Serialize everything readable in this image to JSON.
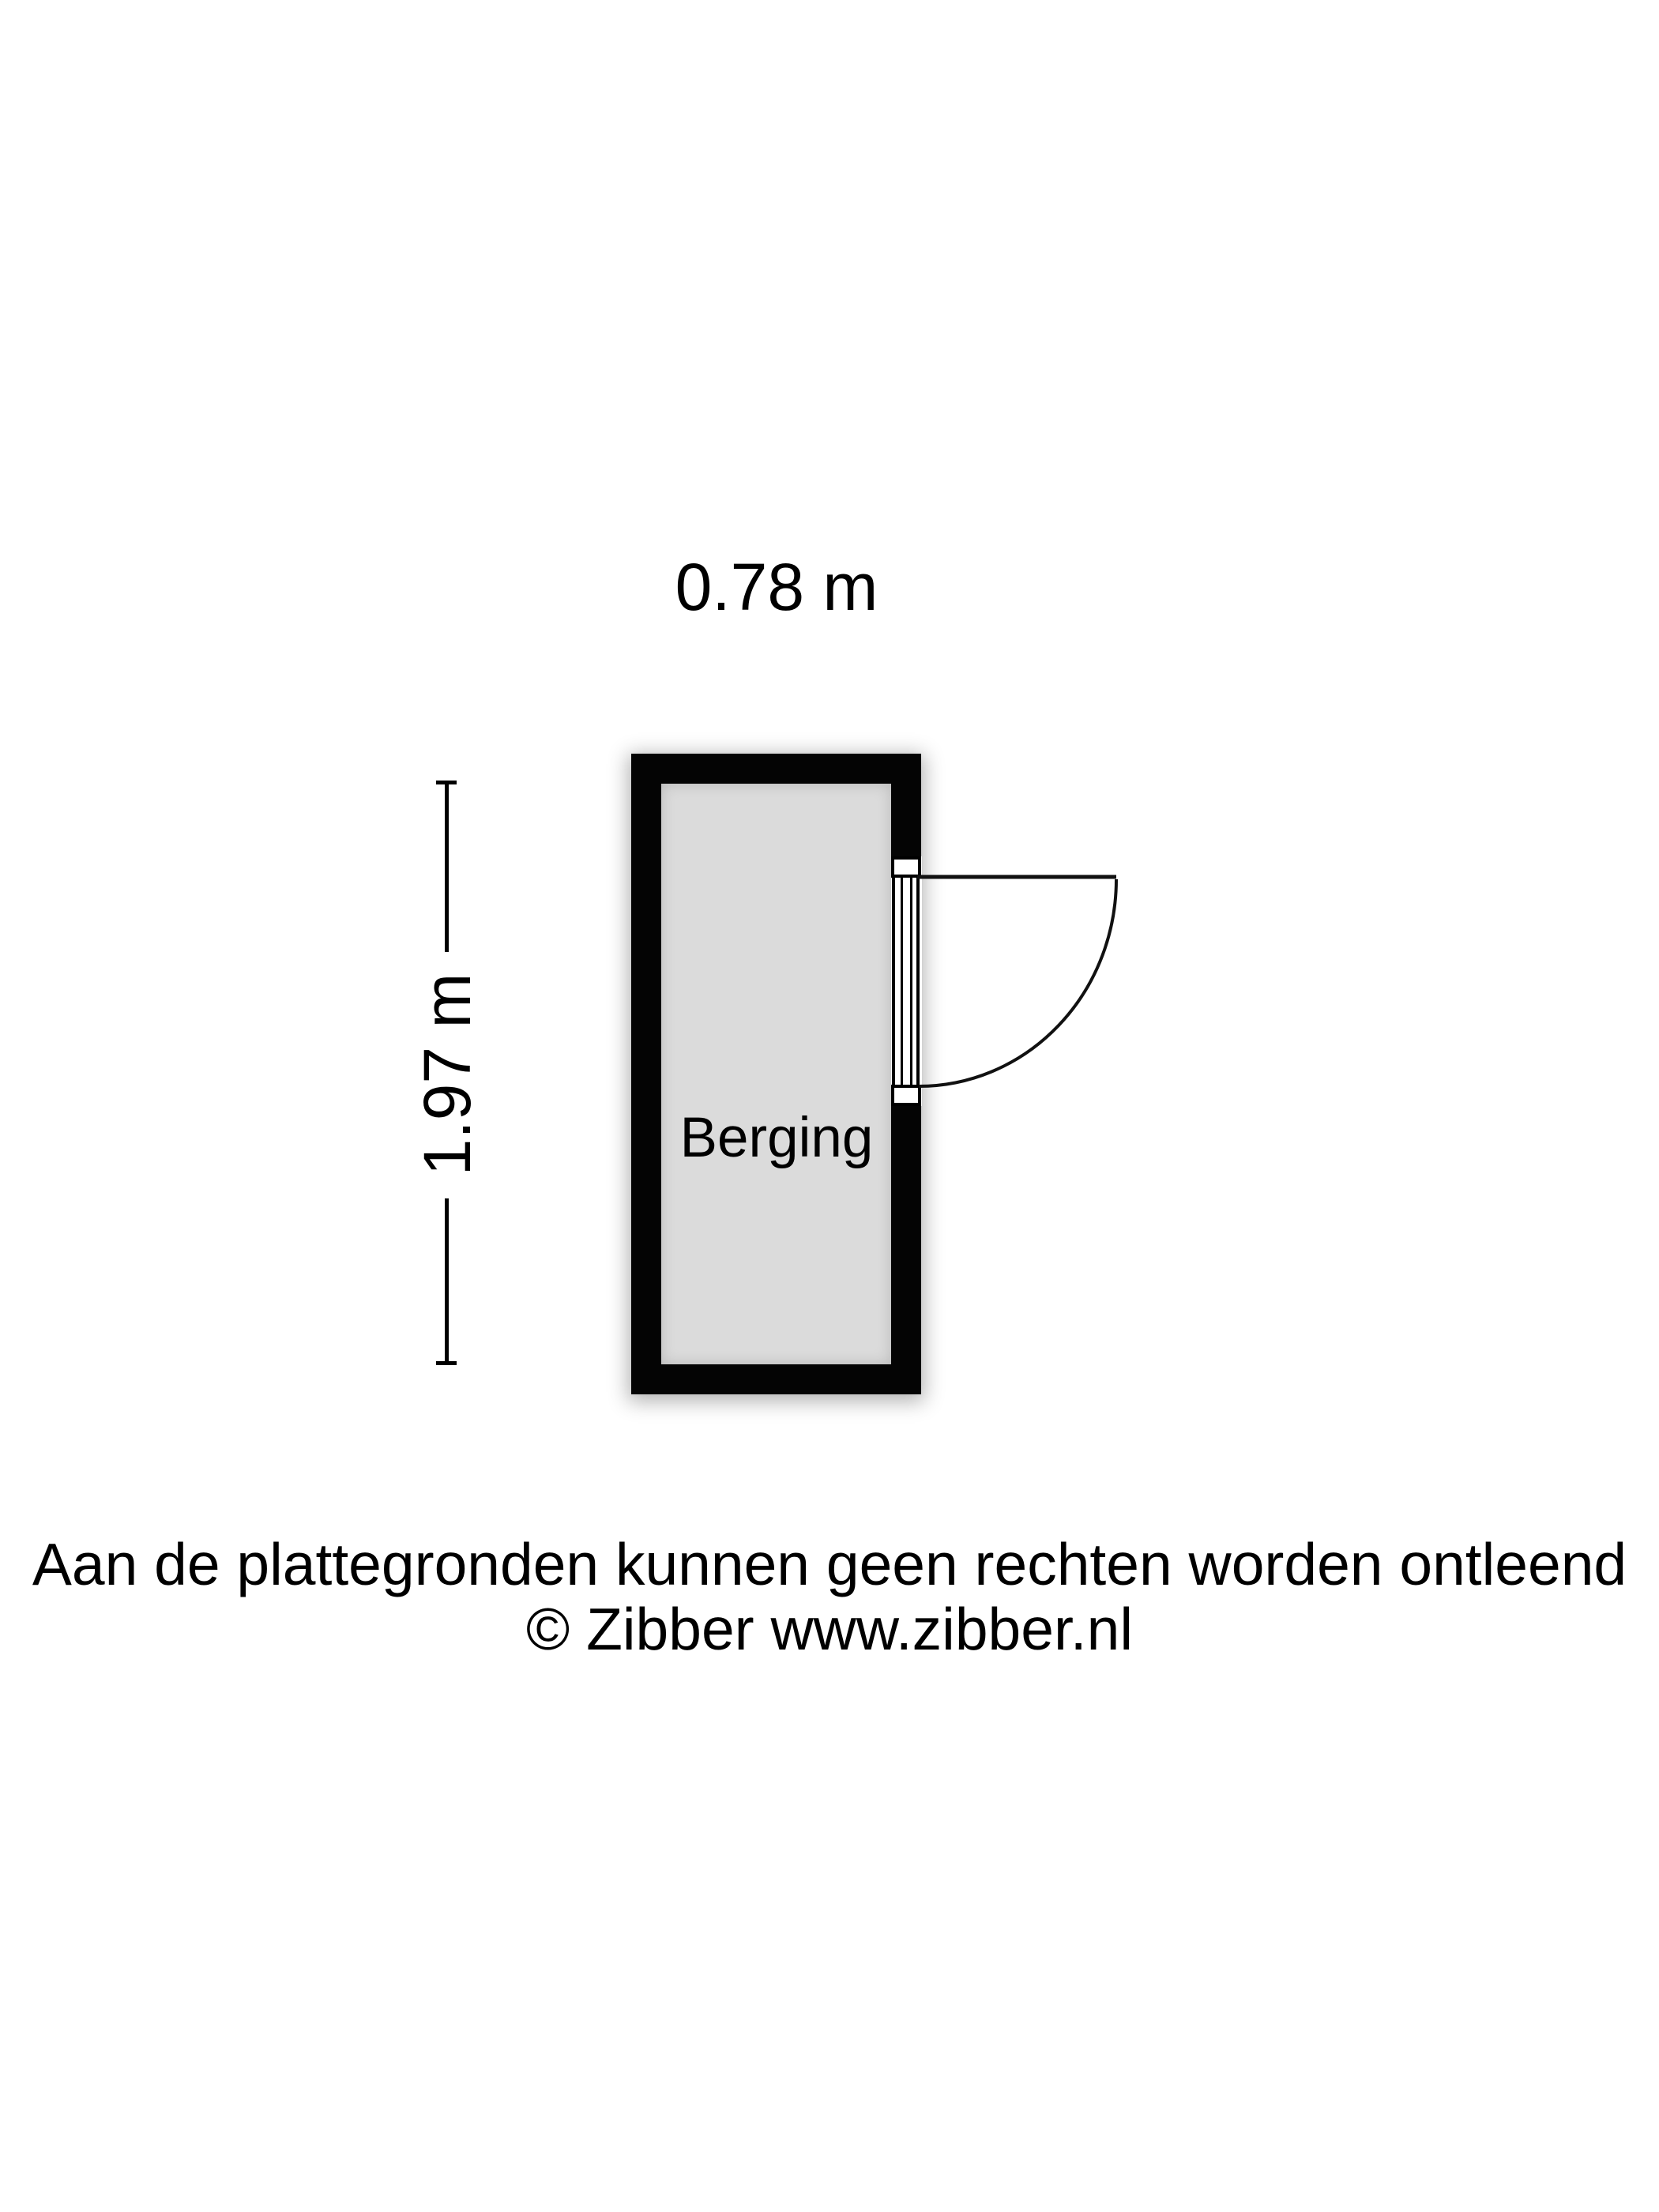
{
  "floorplan": {
    "room_label": "Berging",
    "width_label": "0.78 m",
    "height_label": "1.97 m"
  },
  "footer": {
    "line1": "Aan de plattegronden kunnen geen rechten worden ontleend",
    "line2": "© Zibber www.zibber.nl"
  },
  "colors": {
    "wall": "#040404",
    "floor": "#dbdbdb",
    "background": "#ffffff",
    "text": "#000000"
  }
}
